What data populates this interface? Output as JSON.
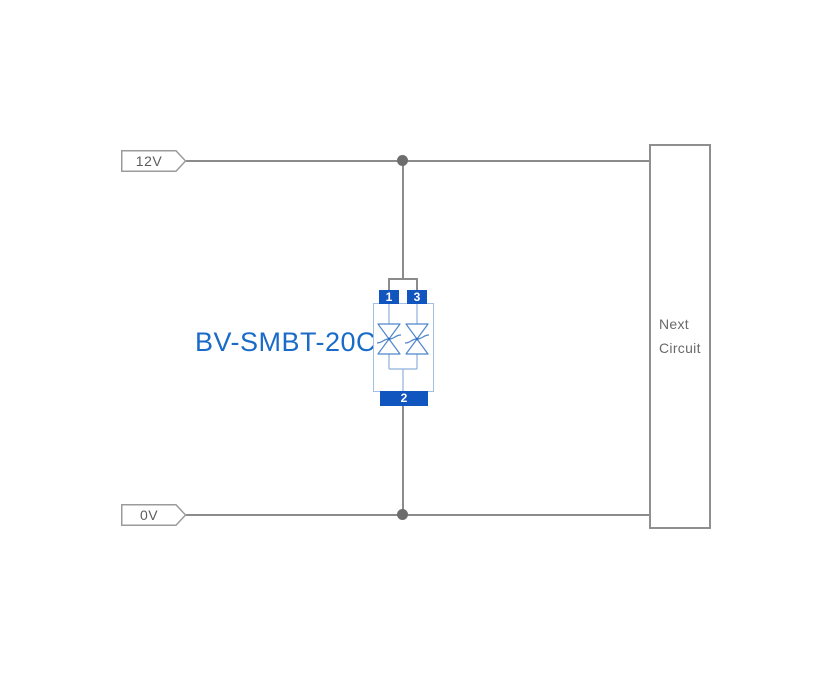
{
  "colors": {
    "background": "#ffffff",
    "wire": "#8b8b8b",
    "junction_dot": "#6d6d6d",
    "tag_border": "#9b9b9b",
    "net_label_text": "#5c5c5c",
    "next_box_border": "#8f8f8f",
    "next_circuit_text": "#6a6a6a",
    "pin_blue": "#1155be",
    "component_label_blue": "#1a6bc8",
    "body_outline_blue": "#a3bfe2",
    "symbol_blue": "#4f86cc"
  },
  "net_labels": {
    "top": "12V",
    "bottom": "0V"
  },
  "component": {
    "label": "BV-SMBT-20CA",
    "pin_top_left": "1",
    "pin_top_right": "3",
    "pin_bottom": "2"
  },
  "next_circuit": {
    "label": "Next Circuit"
  }
}
